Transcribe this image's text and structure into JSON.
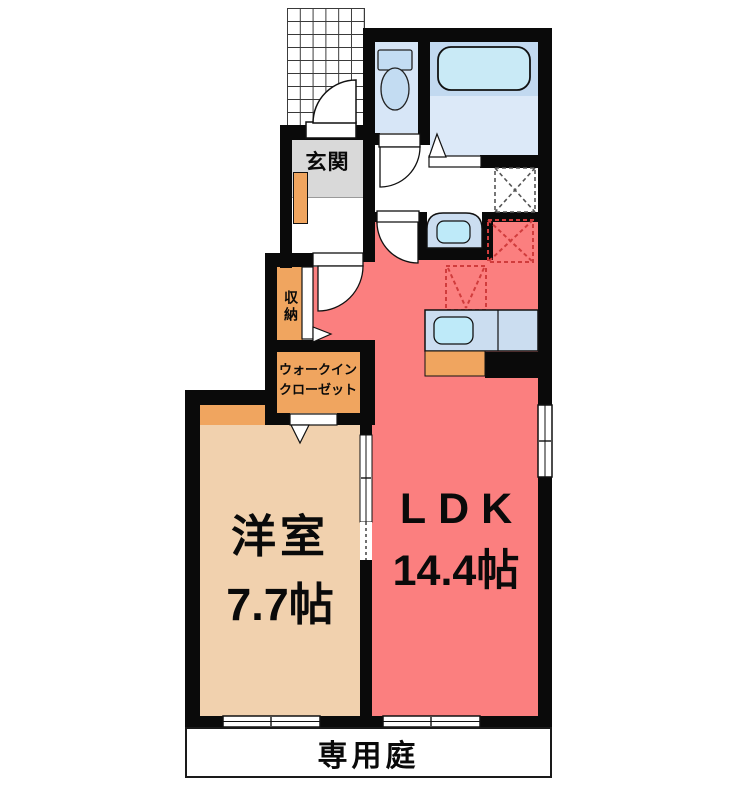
{
  "floorplan": {
    "rooms": {
      "genkan": {
        "label": "玄関"
      },
      "storage": {
        "label": "収納"
      },
      "walk_in_closet": {
        "label_line1": "ウォークイン",
        "label_line2": "クローゼット"
      },
      "western_room": {
        "label": "洋室",
        "size": "7.7帖"
      },
      "ldk": {
        "label": "LDK",
        "size": "14.4帖"
      },
      "private_garden": {
        "label": "専用庭"
      }
    },
    "colors": {
      "wall": "#0a0a0a",
      "ldk-red": "#FB7F7F",
      "room-tan": "#F1D1AE",
      "closet-orange": "#F0A55F",
      "genkan-gray": "#D9D9D9",
      "toilet-floor-blue": "#D7E6F7",
      "bath-floor-blue": "#DCE9F8",
      "tub-band-blue": "#C2D9F0",
      "tub-fill-blue": "#C9EAF6",
      "fixture-blue": "#C3DCF2",
      "sink-cyan": "#BEEAF9",
      "counter-blue": "#CBDDF0",
      "appliance-dash-red": "#D03C3C",
      "washer-dash-gray": "#555555"
    }
  }
}
